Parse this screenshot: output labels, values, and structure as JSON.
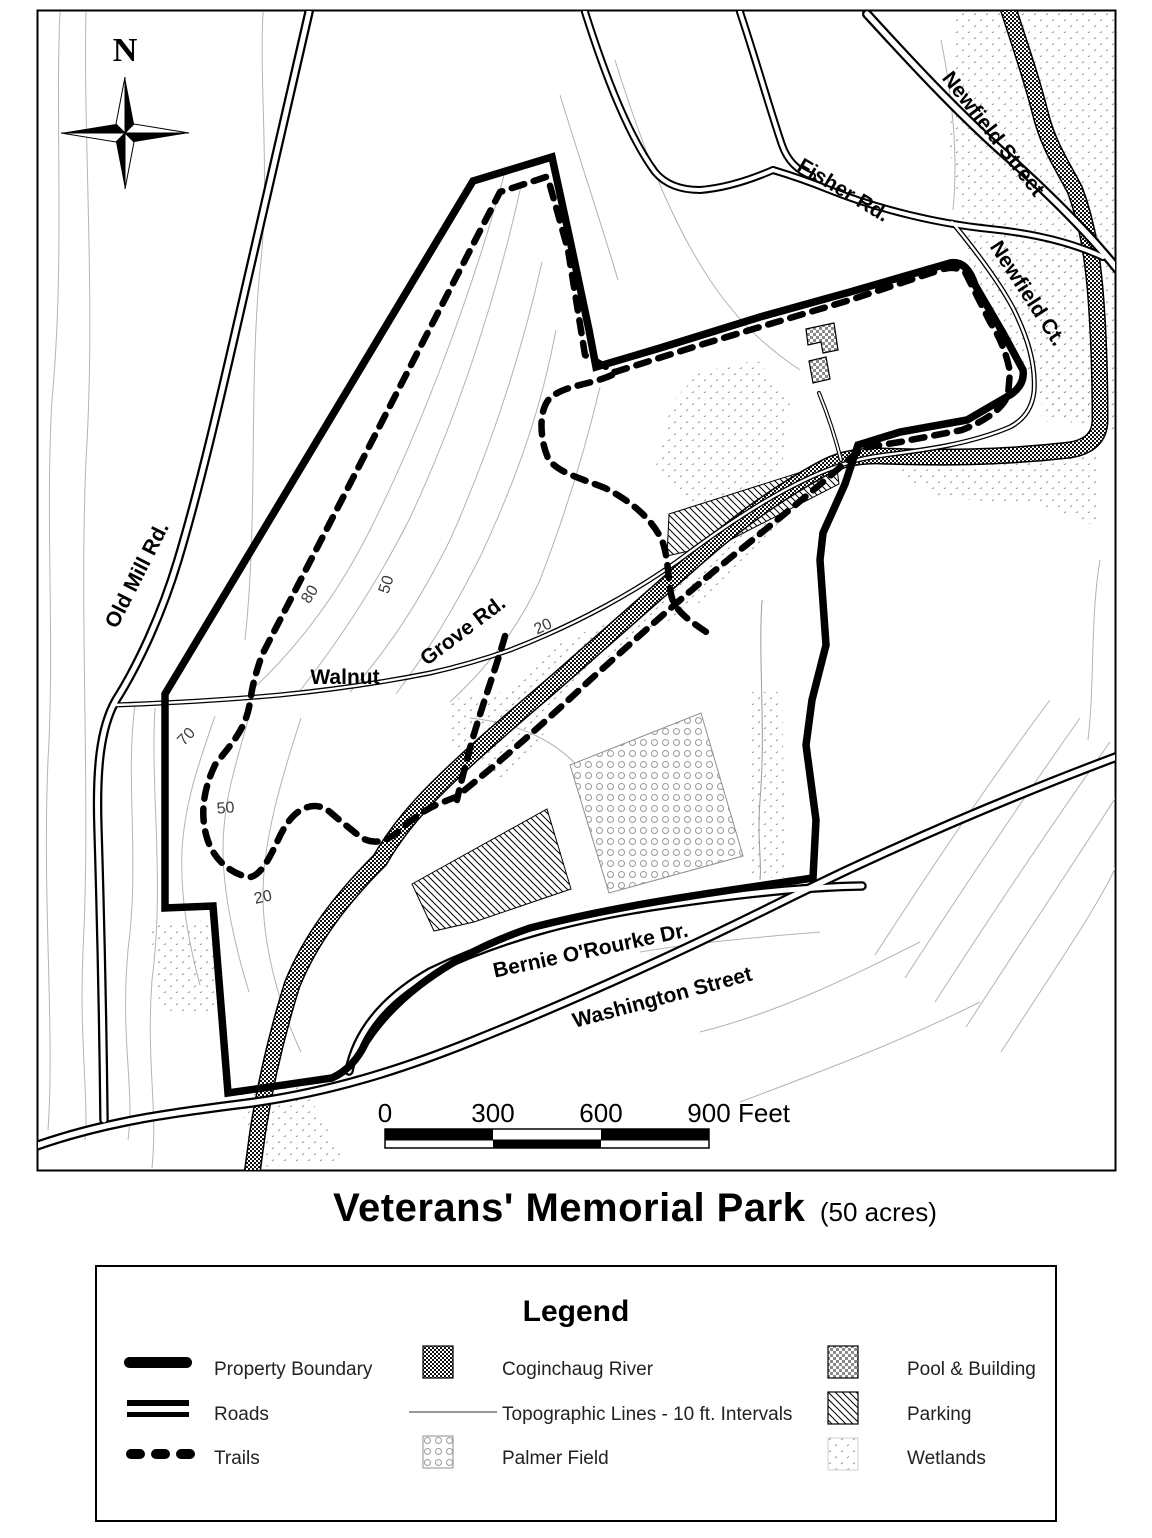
{
  "map": {
    "compass_n": "N",
    "roads": {
      "old_mill": "Old Mill Rd.",
      "fisher": "Fisher Rd.",
      "newfield_street": "Newfield Street",
      "newfield_ct": "Newfield Ct.",
      "walnut": "Walnut",
      "grove": "Grove Rd.",
      "bernie": "Bernie O'Rourke Dr.",
      "washington": "Washington Street"
    },
    "contour_labels": [
      "80",
      "50",
      "20",
      "70",
      "50",
      "20"
    ],
    "scalebar": {
      "zero": "0",
      "three_hundred": "300",
      "six_hundred": "600",
      "nine_hundred": "900",
      "unit": "Feet"
    }
  },
  "title": {
    "main": "Veterans' Memorial Park",
    "suffix": "(50 acres)"
  },
  "legend": {
    "title": "Legend",
    "items": [
      "Property Boundary",
      "Roads",
      "Trails",
      "Coginchaug River",
      "Topographic Lines - 10 ft. Intervals",
      "Palmer Field",
      "Pool & Building",
      "Parking",
      "Wetlands"
    ]
  }
}
